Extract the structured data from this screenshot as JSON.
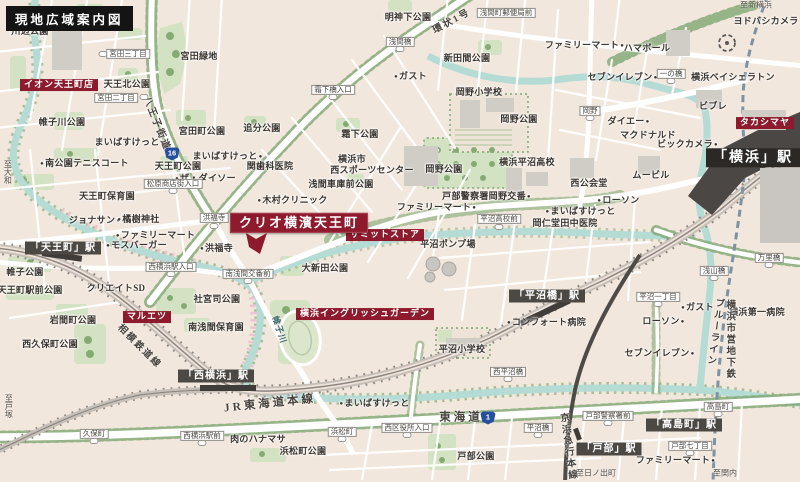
{
  "title": "現地広域案内図",
  "property": {
    "name": "クリオ横濱天王町"
  },
  "colors": {
    "background": "#f2e7dd",
    "accent_red": "#8d1b2d",
    "river": "#b5dbd5",
    "park_green": "#d3e2c3",
    "tree_green": "#7fa873",
    "rail_gray": "#a09a93",
    "station_badge": "#4c4844",
    "route_shield_blue": "#274f9e",
    "title_bg": "#141414"
  },
  "labels": [
    {
      "text": "川辺公園",
      "type": "p",
      "x": 30,
      "y": 32
    },
    {
      "text": "宮田三丁目",
      "type": "b",
      "x": 128,
      "y": 54
    },
    {
      "text": "宮田緑地",
      "type": "p",
      "x": 199,
      "y": 57
    },
    {
      "text": "イオン天王町店",
      "type": "r",
      "x": 59,
      "y": 85
    },
    {
      "text": "天王北公園",
      "type": "p",
      "x": 127,
      "y": 85
    },
    {
      "text": "宮田二丁目",
      "type": "b",
      "x": 116,
      "y": 98
    },
    {
      "text": "帷子川公園",
      "type": "p",
      "x": 62,
      "y": 123
    },
    {
      "text": "宮田町公園",
      "type": "p",
      "x": 202,
      "y": 132
    },
    {
      "text": "まいばすけっと",
      "type": "s",
      "dot": "r",
      "x": 130,
      "y": 143
    },
    {
      "text": "八王子街道",
      "type": "rd",
      "x": 156,
      "y": 124,
      "rot": 68
    },
    {
      "text": "16",
      "type": "sh",
      "x": 172,
      "y": 154
    },
    {
      "text": "まいばすけっと",
      "type": "s",
      "dot": "r",
      "x": 228,
      "y": 157
    },
    {
      "text": "関歯科医院",
      "type": "p",
      "x": 270,
      "y": 167
    },
    {
      "text": "明神下公園",
      "type": "p",
      "x": 408,
      "y": 18
    },
    {
      "text": "浅間橋",
      "type": "b",
      "x": 400,
      "y": 42
    },
    {
      "text": "環状1号",
      "type": "rd",
      "x": 452,
      "y": 22,
      "rot": -28
    },
    {
      "text": "浅間町郵便局前",
      "type": "b",
      "x": 506,
      "y": 13
    },
    {
      "text": "新田間公園",
      "type": "p",
      "x": 467,
      "y": 59
    },
    {
      "text": "ガスト",
      "type": "s",
      "dot": "l",
      "x": 410,
      "y": 77
    },
    {
      "text": "霜下橋入口",
      "type": "b",
      "x": 333,
      "y": 90
    },
    {
      "text": "岡野小学校",
      "type": "p",
      "x": 479,
      "y": 93
    },
    {
      "text": "追分公園",
      "type": "p",
      "x": 262,
      "y": 129
    },
    {
      "text": "霜下公園",
      "type": "p",
      "x": 360,
      "y": 135
    },
    {
      "text": "岡野公園",
      "type": "p",
      "x": 519,
      "y": 120
    },
    {
      "text": "岡野公園",
      "type": "p",
      "x": 444,
      "y": 170
    },
    {
      "text": "ファミリーマート",
      "type": "s",
      "dot": "r",
      "x": 585,
      "y": 46
    },
    {
      "text": "ハマボール",
      "type": "p",
      "x": 647,
      "y": 49
    },
    {
      "text": "ヨドバシカメラ",
      "type": "p",
      "x": 766,
      "y": 22
    },
    {
      "text": "至新横浜",
      "type": "d",
      "x": 756,
      "y": 6
    },
    {
      "text": "セブンイレブン",
      "type": "s",
      "dot": "r",
      "x": 623,
      "y": 78
    },
    {
      "text": "一の橋",
      "type": "b",
      "x": 671,
      "y": 74
    },
    {
      "text": "横浜ベイシェラトン",
      "type": "p",
      "x": 733,
      "y": 78
    },
    {
      "text": "ビブレ",
      "type": "p",
      "x": 713,
      "y": 107
    },
    {
      "text": "岡野",
      "type": "b",
      "x": 590,
      "y": 111
    },
    {
      "text": "ダイエー",
      "type": "s",
      "dot": "r",
      "x": 629,
      "y": 122
    },
    {
      "text": "タカシマヤ",
      "type": "r",
      "x": 765,
      "y": 123
    },
    {
      "text": "マクドナルド",
      "type": "p",
      "x": 648,
      "y": 136
    },
    {
      "text": "ビックカメラ",
      "type": "s",
      "dot": "r",
      "x": 688,
      "y": 145
    },
    {
      "text": "「横浜」駅",
      "type": "stl",
      "x": 753,
      "y": 158
    },
    {
      "text": "ムービル",
      "type": "p",
      "x": 651,
      "y": 176
    },
    {
      "text": "西公会堂",
      "type": "p",
      "x": 589,
      "y": 184
    },
    {
      "text": "横浜平沼高校",
      "type": "p",
      "x": 527,
      "y": 163
    },
    {
      "text": "戸部警察署岡野交番",
      "type": "s",
      "dot": "r",
      "x": 487,
      "y": 197
    },
    {
      "text": "ローソン",
      "type": "s",
      "dot": "l",
      "x": 618,
      "y": 201
    },
    {
      "text": "ファミリーマート",
      "type": "s",
      "dot": "r",
      "x": 437,
      "y": 208
    },
    {
      "text": "平沼高校前",
      "type": "b",
      "x": 499,
      "y": 219
    },
    {
      "text": "まいばすけっと",
      "type": "s",
      "dot": "l",
      "x": 580,
      "y": 212
    },
    {
      "text": "岡仁堂田中医院",
      "type": "p",
      "x": 565,
      "y": 224
    },
    {
      "text": "平沼ポンプ場",
      "type": "p",
      "x": 448,
      "y": 245
    },
    {
      "text": "「平沼橋」駅",
      "type": "st",
      "x": 547,
      "y": 296
    },
    {
      "text": "平沼一丁目",
      "type": "b",
      "x": 658,
      "y": 297
    },
    {
      "text": "コンフォート病院",
      "type": "s",
      "dot": "l",
      "x": 546,
      "y": 323
    },
    {
      "text": "ローソン",
      "type": "s",
      "dot": "r",
      "x": 664,
      "y": 322
    },
    {
      "text": "ガスト",
      "type": "s",
      "dot": "l",
      "x": 697,
      "y": 308
    },
    {
      "text": "セブンイレブン",
      "type": "s",
      "dot": "r",
      "x": 660,
      "y": 354
    },
    {
      "text": "横浜第一病院",
      "type": "p",
      "x": 757,
      "y": 313
    },
    {
      "text": "万里橋",
      "type": "b",
      "x": 769,
      "y": 258
    },
    {
      "text": "浅山橋",
      "type": "b",
      "x": 714,
      "y": 271
    },
    {
      "text": "横浜市営地下鉄",
      "type": "rd",
      "x": 729,
      "y": 340,
      "vert": true
    },
    {
      "text": "ブルーライン",
      "type": "rd",
      "x": 714,
      "y": 332,
      "vert": true,
      "rot": 8
    },
    {
      "text": "平沼小学校",
      "type": "p",
      "x": 462,
      "y": 350
    },
    {
      "text": "西平沼橋",
      "type": "b",
      "x": 508,
      "y": 372
    },
    {
      "text": "横浜イングリッシュガーデン",
      "type": "r",
      "x": 365,
      "y": 314
    },
    {
      "text": "帷子川",
      "type": "rv",
      "x": 279,
      "y": 330,
      "rot": 72
    },
    {
      "text": "相模鉄道線",
      "type": "rd",
      "x": 139,
      "y": 347,
      "rot": 45
    },
    {
      "text": "「西横浜」駅",
      "type": "st",
      "x": 216,
      "y": 376
    },
    {
      "text": "JR東海道本線",
      "type": "rd2",
      "x": 270,
      "y": 404,
      "rot": -6
    },
    {
      "text": "まいばすけっと",
      "type": "s",
      "dot": "l",
      "x": 374,
      "y": 404
    },
    {
      "text": "東海道",
      "type": "rd2",
      "x": 461,
      "y": 418
    },
    {
      "text": "1",
      "type": "sh",
      "x": 488,
      "y": 418
    },
    {
      "text": "西区役所入口",
      "type": "b",
      "x": 407,
      "y": 428
    },
    {
      "text": "浜松町",
      "type": "b",
      "x": 342,
      "y": 432
    },
    {
      "text": "肉のハナマサ",
      "type": "p",
      "x": 258,
      "y": 440
    },
    {
      "text": "浜松町公園",
      "type": "p",
      "x": 303,
      "y": 452
    },
    {
      "text": "戸部公園",
      "type": "p",
      "x": 476,
      "y": 457
    },
    {
      "text": "久保町",
      "type": "b",
      "x": 94,
      "y": 434
    },
    {
      "text": "西横浜駅前",
      "type": "b",
      "x": 202,
      "y": 436
    },
    {
      "text": "至戸塚",
      "type": "d",
      "x": 8,
      "y": 406,
      "vert": true
    },
    {
      "text": "至大和",
      "type": "d",
      "x": 7,
      "y": 172,
      "vert": true
    },
    {
      "text": "戸部警察署前",
      "type": "b",
      "x": 608,
      "y": 416
    },
    {
      "text": "「高島町」駅",
      "type": "st",
      "x": 684,
      "y": 425
    },
    {
      "text": "高島町",
      "type": "b",
      "x": 718,
      "y": 407
    },
    {
      "text": "「戸部」駅",
      "type": "st",
      "x": 609,
      "y": 449
    },
    {
      "text": "戸部七丁目",
      "type": "b",
      "x": 690,
      "y": 446
    },
    {
      "text": "ファミリーマート",
      "type": "s",
      "dot": "r",
      "x": 676,
      "y": 461
    },
    {
      "text": "京浜急行本線",
      "type": "rd",
      "x": 567,
      "y": 447,
      "vert": true,
      "rot": -8
    },
    {
      "text": "至日ノ出町",
      "type": "d",
      "x": 596,
      "y": 474
    },
    {
      "text": "至関内",
      "type": "d",
      "x": 725,
      "y": 474
    },
    {
      "text": "平沼橋",
      "type": "b",
      "x": 538,
      "y": 428
    },
    {
      "text": "南公園テニスコート",
      "type": "s",
      "dot": "l",
      "x": 84,
      "y": 164
    },
    {
      "text": "天王町公園",
      "type": "p",
      "x": 178,
      "y": 167
    },
    {
      "text": "ザ・ダイソー",
      "type": "s",
      "dot": "l",
      "x": 205,
      "y": 179
    },
    {
      "text": "松原商店街入口",
      "type": "b",
      "x": 173,
      "y": 184
    },
    {
      "text": "天王町保育園",
      "type": "p",
      "x": 107,
      "y": 197
    },
    {
      "text": "ジョナサン",
      "type": "s",
      "dot": "r",
      "x": 95,
      "y": 221
    },
    {
      "text": "橘樹神社",
      "type": "s",
      "dot": "l",
      "x": 138,
      "y": 220
    },
    {
      "text": "ファミリーマート",
      "type": "s",
      "dot": "l",
      "x": 155,
      "y": 236
    },
    {
      "text": "モスバーガー",
      "type": "s",
      "dot": "l",
      "x": 136,
      "y": 246
    },
    {
      "text": "「天王町」駅",
      "type": "st",
      "x": 63,
      "y": 248
    },
    {
      "text": "帷子公園",
      "type": "p",
      "x": 25,
      "y": 273
    },
    {
      "text": "天王町駅前公園",
      "type": "p",
      "x": 30,
      "y": 291
    },
    {
      "text": "クリエイトSD",
      "type": "p",
      "x": 116,
      "y": 289
    },
    {
      "text": "西横浜駅入口",
      "type": "b",
      "x": 171,
      "y": 267
    },
    {
      "text": "洪福寺",
      "type": "b",
      "x": 214,
      "y": 218
    },
    {
      "text": "洪福寺",
      "type": "s",
      "dot": "l",
      "x": 216,
      "y": 249
    },
    {
      "text": "クリオ横濱天王町",
      "type": "m",
      "x": 299,
      "y": 223
    },
    {
      "text": "木村クリニック",
      "type": "s",
      "dot": "l",
      "x": 292,
      "y": 201
    },
    {
      "text": "横浜市",
      "type": "p",
      "x": 352,
      "y": 160
    },
    {
      "text": "西スポーツセンター",
      "type": "p",
      "x": 372,
      "y": 171
    },
    {
      "text": "浅間車庫前公園",
      "type": "p",
      "x": 341,
      "y": 185
    },
    {
      "text": "サミットストア",
      "type": "r",
      "x": 385,
      "y": 235
    },
    {
      "text": "大新田公園",
      "type": "p",
      "x": 325,
      "y": 269
    },
    {
      "text": "南浅間交番前",
      "type": "b",
      "x": 248,
      "y": 274
    },
    {
      "text": "社宮司公園",
      "type": "p",
      "x": 217,
      "y": 300
    },
    {
      "text": "マルエツ",
      "type": "r",
      "x": 147,
      "y": 317
    },
    {
      "text": "南浅間保育園",
      "type": "p",
      "x": 216,
      "y": 328
    },
    {
      "text": "岩間町公園",
      "type": "p",
      "x": 73,
      "y": 321
    },
    {
      "text": "西久保町公園",
      "type": "p",
      "x": 50,
      "y": 345
    },
    {
      "type": "ov",
      "text": "",
      "x": 103,
      "y": 54
    },
    {
      "type": "ov",
      "text": "",
      "x": 144,
      "y": 97
    },
    {
      "type": "ov",
      "text": "",
      "x": 400,
      "y": 49
    },
    {
      "type": "ov",
      "text": "",
      "x": 333,
      "y": 97
    },
    {
      "type": "ov",
      "text": "",
      "x": 214,
      "y": 226
    },
    {
      "type": "ov",
      "text": "",
      "x": 171,
      "y": 274
    },
    {
      "type": "ov",
      "text": "",
      "x": 248,
      "y": 281
    },
    {
      "type": "ov",
      "text": "",
      "x": 173,
      "y": 191
    },
    {
      "type": "ov",
      "text": "",
      "x": 499,
      "y": 227
    },
    {
      "type": "ov",
      "text": "",
      "x": 590,
      "y": 118
    },
    {
      "type": "ov",
      "text": "",
      "x": 671,
      "y": 81
    },
    {
      "type": "ov",
      "text": "",
      "x": 769,
      "y": 265
    },
    {
      "type": "ov",
      "text": "",
      "x": 714,
      "y": 278
    },
    {
      "type": "ov",
      "text": "",
      "x": 658,
      "y": 304
    },
    {
      "type": "ov",
      "text": "",
      "x": 508,
      "y": 379
    },
    {
      "type": "ov",
      "text": "",
      "x": 342,
      "y": 439
    },
    {
      "type": "ov",
      "text": "",
      "x": 407,
      "y": 435
    },
    {
      "type": "ov",
      "text": "",
      "x": 94,
      "y": 441
    },
    {
      "type": "ov",
      "text": "",
      "x": 202,
      "y": 443
    },
    {
      "type": "ov",
      "text": "",
      "x": 608,
      "y": 423
    },
    {
      "type": "ov",
      "text": "",
      "x": 718,
      "y": 414
    },
    {
      "type": "ov",
      "text": "",
      "x": 690,
      "y": 453
    },
    {
      "type": "ov",
      "text": "",
      "x": 538,
      "y": 435
    }
  ]
}
